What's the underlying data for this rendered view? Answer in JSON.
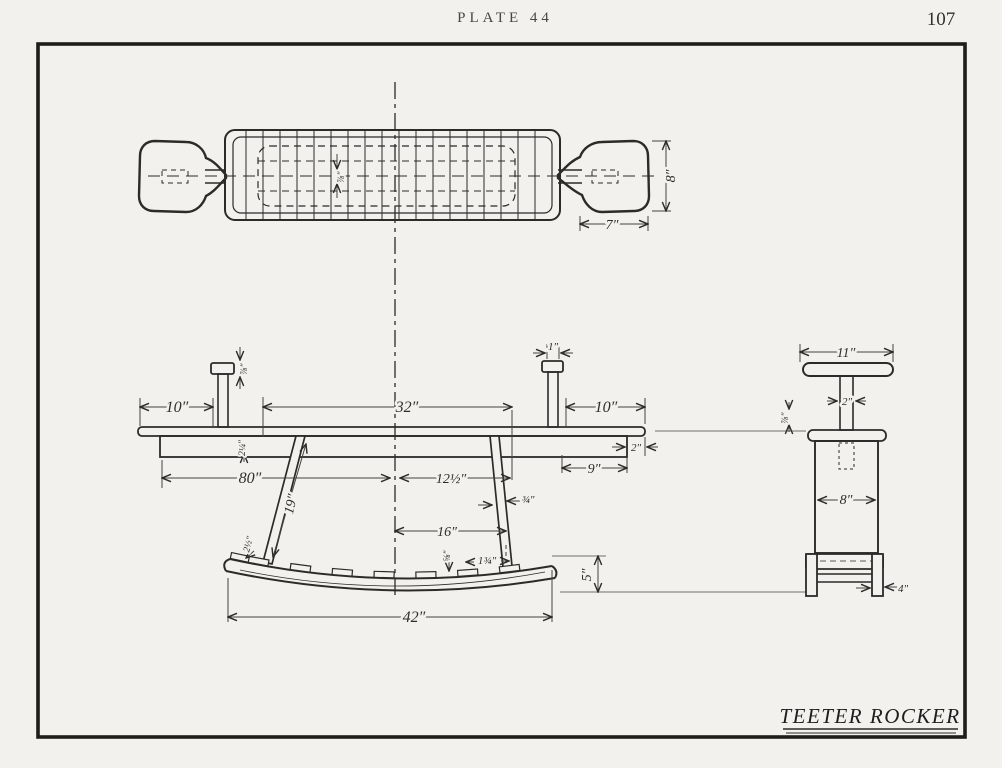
{
  "page": {
    "plate_label": "PLATE 44",
    "page_number": "107",
    "drawing_title": "TEETER ROCKER"
  },
  "top_view": {
    "paddle_width": "7″",
    "paddle_height": "8″",
    "board_thickness": "⅞″"
  },
  "elevation": {
    "left_overhang": "10″",
    "center_span": "32″",
    "right_overhang": "10″",
    "post_width": "1″",
    "post_cap_thickness": "⅞″",
    "seat_rail_thickness": "2¼″",
    "board_length": "80″",
    "rail_right": "9″",
    "rail_end_offset": "2″",
    "half_span": "12½″",
    "leg_thickness": "¾″",
    "leg_length": "19″",
    "base_half_span": "16″",
    "rocker_length": "42″",
    "rocker_rise": "5″",
    "cleat_height": "⅝″",
    "cleat_spacing": "1¾″",
    "rocker_tip": "2½″"
  },
  "end_view": {
    "handle_width": "11″",
    "post_width": "2″",
    "seat_lip": "⅞″",
    "body_width": "8″",
    "leg_width": "4″"
  }
}
